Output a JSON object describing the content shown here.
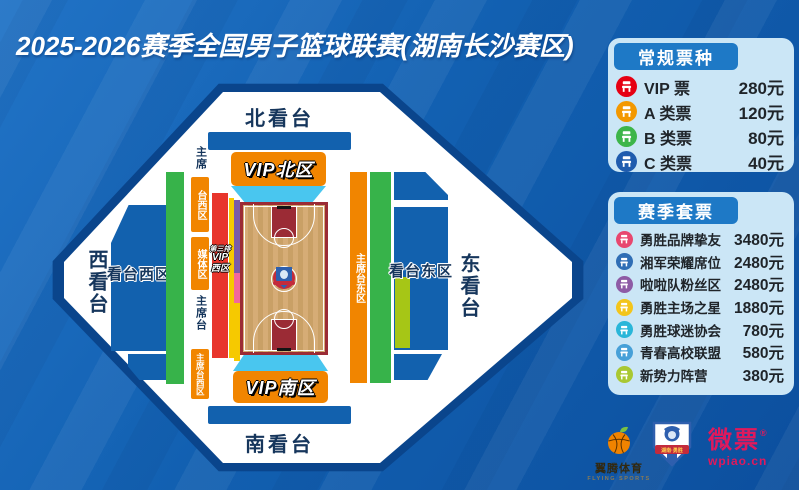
{
  "title": "2025-2026赛季全国男子篮球联赛(湖南长沙赛区)",
  "stadium": {
    "north_stand": "北看台",
    "south_stand": "南看台",
    "west_stand": "西看台",
    "east_stand": "东看台",
    "vip_north": "VIP北区",
    "vip_south": "VIP南区",
    "west_block": "看台西区",
    "east_block": "看台东区",
    "west_column": {
      "chair_label_top": "主席",
      "chair_box_top": "台西区",
      "media_box": "媒体区",
      "chair_label_mid": "主席台",
      "chair_box_bottom": "主席台西区"
    },
    "third_row_vip": {
      "line1": "第三排",
      "line2": "VIP",
      "line3": "西区"
    },
    "east_chair_strip": "主席台东区"
  },
  "regular_tickets": {
    "header": "常规票种",
    "items": [
      {
        "label": "VIP 票",
        "price": "280元",
        "color": "#e60013"
      },
      {
        "label": "A 类票",
        "price": "120元",
        "color": "#f39800"
      },
      {
        "label": "B 类票",
        "price": "80元",
        "color": "#3db54a"
      },
      {
        "label": "C 类票",
        "price": "40元",
        "color": "#1f5cae"
      }
    ]
  },
  "season_tickets": {
    "header": "赛季套票",
    "items": [
      {
        "label": "勇胜品牌挚友",
        "price": "3480元",
        "color": "#e8476f"
      },
      {
        "label": "湘军荣耀席位",
        "price": "2480元",
        "color": "#2f6eb5"
      },
      {
        "label": "啦啦队粉丝区",
        "price": "2480元",
        "color": "#8e5ba5"
      },
      {
        "label": "勇胜主场之星",
        "price": "1880元",
        "color": "#f3c51c"
      },
      {
        "label": "勇胜球迷协会",
        "price": "780元",
        "color": "#2ab6d9"
      },
      {
        "label": "青春高校联盟",
        "price": "580元",
        "color": "#47a0d8"
      },
      {
        "label": "新势力阵营",
        "price": "380元",
        "color": "#a9c832"
      }
    ]
  },
  "footer_brands": {
    "flying_sports_cn": "翼腾体育",
    "flying_sports_en": "FLYING SPORTS",
    "lion_badge": "湖南·勇胜",
    "wpiao_cn": "微票",
    "wpiao_reg": "®",
    "wpiao_url": "wpiao.cn"
  },
  "map_colors": {
    "stand_blue": "#1261ae",
    "vip_orange": "#f18500",
    "green_zone": "#37b34a",
    "red_zone": "#e8352c",
    "cyan_zone": "#49c6ef",
    "yellow_zone": "#f6c900",
    "purple_zone": "#7a5aa8",
    "pink_zone": "#f2679c",
    "lime_zone": "#a6c616"
  }
}
